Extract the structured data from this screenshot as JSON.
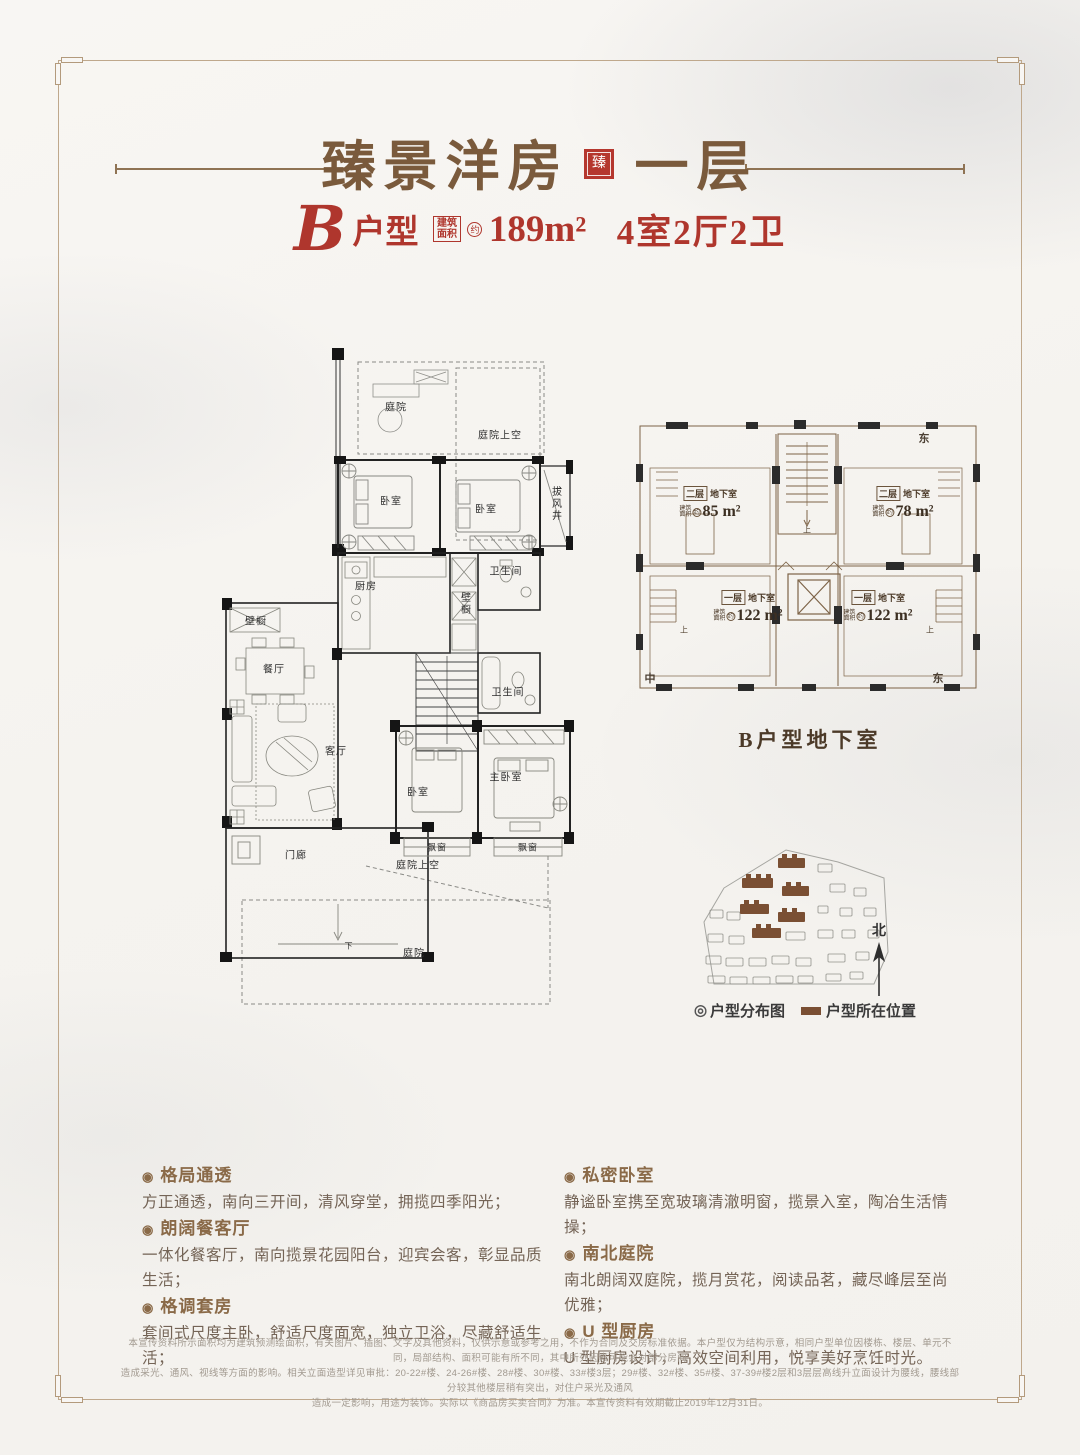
{
  "header": {
    "title": "臻景洋房",
    "floor": "一层",
    "seal": "臻",
    "unit_letter": "B",
    "unit_label": "户型",
    "area_box": [
      "建筑",
      "面积"
    ],
    "approx": "约",
    "area": "189m²",
    "layout": "4室2厅2卫"
  },
  "floorplan": {
    "courtyard_top": "庭院",
    "courtyard_sky": "庭院上空",
    "bedroom_a": "卧室",
    "bedroom_b": "卧室",
    "wind_shaft": "拔风井",
    "kitchen": "厨房",
    "closet_a": "壁橱",
    "closet_b": "壁橱",
    "bath_a": "卫生间",
    "dining": "餐厅",
    "living": "客厅",
    "bath_b": "卫生间",
    "bedroom_c": "卧室",
    "master": "主卧室",
    "bay_a": "飘窗",
    "bay_b": "飘窗",
    "porch": "门廊",
    "courtyard_sky_mid": "庭院上空",
    "courtyard_bottom": "庭院",
    "down": "下"
  },
  "basement": {
    "caption": "B户型地下室",
    "up": "上",
    "dir_top_right": "东",
    "dir_bottom_left": "中",
    "dir_bottom_right": "东",
    "units": [
      {
        "floor": "二层",
        "hall": "地下室",
        "a1": "建筑",
        "a2": "面积",
        "approx": "约",
        "area": "85 m²"
      },
      {
        "floor": "二层",
        "hall": "地下室",
        "a1": "建筑",
        "a2": "面积",
        "approx": "约",
        "area": "78 m²"
      },
      {
        "floor": "一层",
        "hall": "地下室",
        "a1": "建筑",
        "a2": "面积",
        "approx": "约",
        "area": "122 m²"
      },
      {
        "floor": "一层",
        "hall": "地下室",
        "a1": "建筑",
        "a2": "面积",
        "approx": "约",
        "area": "122 m²"
      }
    ]
  },
  "siteplan": {
    "legend_bullet": "◎",
    "legend_map": "户型分布图",
    "legend_loc": "户型所在位置",
    "north": "北"
  },
  "features": {
    "left": [
      {
        "title": "格局通透",
        "body": "方正通透，南向三开间，清风穿堂，拥揽四季阳光；"
      },
      {
        "title": "朗阔餐客厅",
        "body": "一体化餐客厅，南向揽景花园阳台，迎宾会客，彰显品质生活；"
      },
      {
        "title": "格调套房",
        "body": "套间式尺度主卧，舒适尺度面宽，独立卫浴，尽藏舒适生活；"
      }
    ],
    "right": [
      {
        "title": "私密卧室",
        "body": "静谧卧室携至宽玻璃清澈明窗，揽景入室，陶冶生活情操；"
      },
      {
        "title": "南北庭院",
        "body": "南北朗阔双庭院，揽月赏花，阅读品茗，藏尽峰层至尚优雅；"
      },
      {
        "title": "U 型厨房",
        "body": "U 型厨房设计，高效空间利用，悦享美好烹饪时光。"
      }
    ]
  },
  "disclaimer": {
    "line1": "本宣传资料所示面积均为建筑预测绘面积，有关图片、插图、文字及其他资料，仅供示意或参考之用，不作为合同及交房标准依据。本户型仅为结构示意，相同户型单位因楼栋、楼层、单元不同，局部结构、面积可能有所不同，其中所列因素可能会对部分房间",
    "line2": "造成采光、通风、视线等方面的影响。相关立面造型详见审批：20-22#楼、24-26#楼、28#楼、30#楼、33#楼3层；29#楼、32#楼、35#楼、37-39#楼2层和3层层高线升立面设计为腰线，腰线部分较其他楼层稍有突出，对住户采光及通风",
    "line3": "造成一定影响，用途为装饰。实际以《商品房买卖合同》为准。本宣传资料有效期截止2019年12月31日。"
  },
  "colors": {
    "accent_red": "#b0362e",
    "title_brown": "#7a5a3c",
    "site_highlight": "#7a4f33"
  }
}
